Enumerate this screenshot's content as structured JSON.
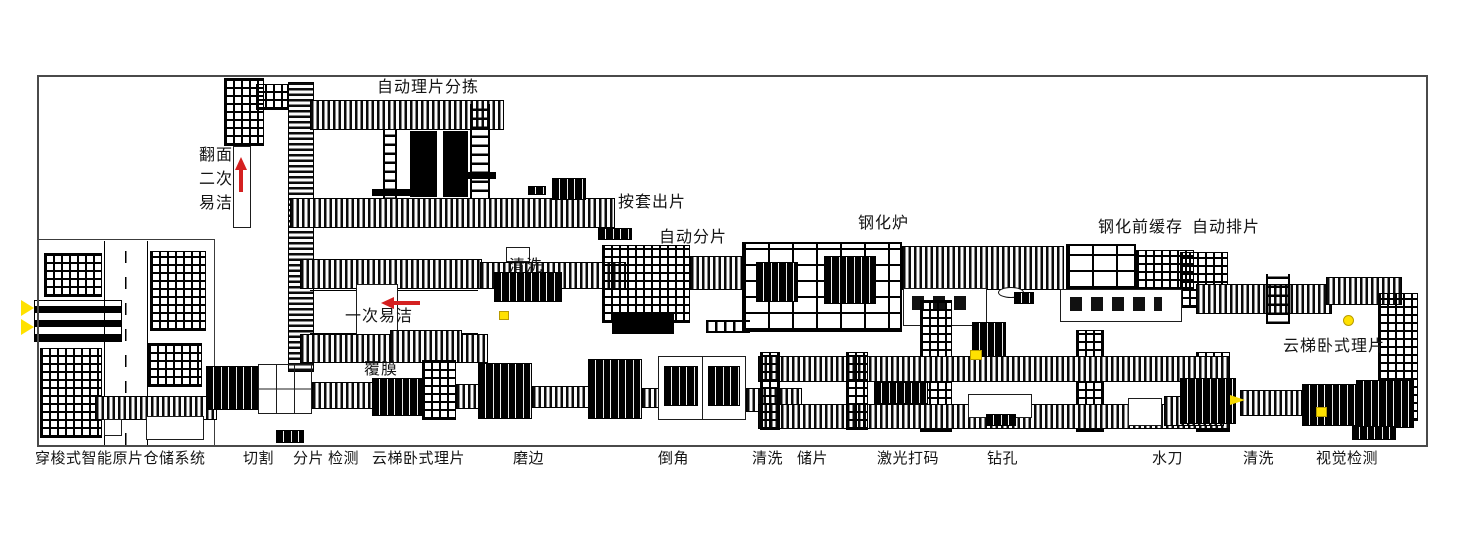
{
  "labels": {
    "auto_sheet_sorting": "自动理片分拣",
    "flip_line1": "翻面",
    "flip_line2": "二次",
    "flip_line3": "易洁",
    "sleeve_output": "按套出片",
    "auto_splitting": "自动分片",
    "tempering_furnace": "钢化炉",
    "pre_tempering_buffer": "钢化前缓存",
    "auto_arranging": "自动排片",
    "washing_mid": "清洗",
    "first_easy_clean": "一次易洁",
    "ladder_horizontal_sorter_right": "云梯卧式理片",
    "film_laminating": "覆膜",
    "shuttle_storage_system": "穿梭式智能原片仓储系统",
    "cutting": "切割",
    "splitting": "分片",
    "inspection": "检测",
    "ladder_horizontal_sorter_bottom": "云梯卧式理片",
    "edging": "磨边",
    "chamfering": "倒角",
    "washing_bottom_left": "清洗",
    "sheet_buffer": "储片",
    "laser_marking": "激光打码",
    "drilling": "钻孔",
    "waterjet": "水刀",
    "washing_bottom_right": "清洗",
    "visual_inspection": "视觉检测"
  },
  "colors": {
    "line_black": "#000000",
    "frame_gray": "#4a4a4a",
    "arrow_red": "#d42020",
    "marker_yellow": "#ffe100"
  }
}
